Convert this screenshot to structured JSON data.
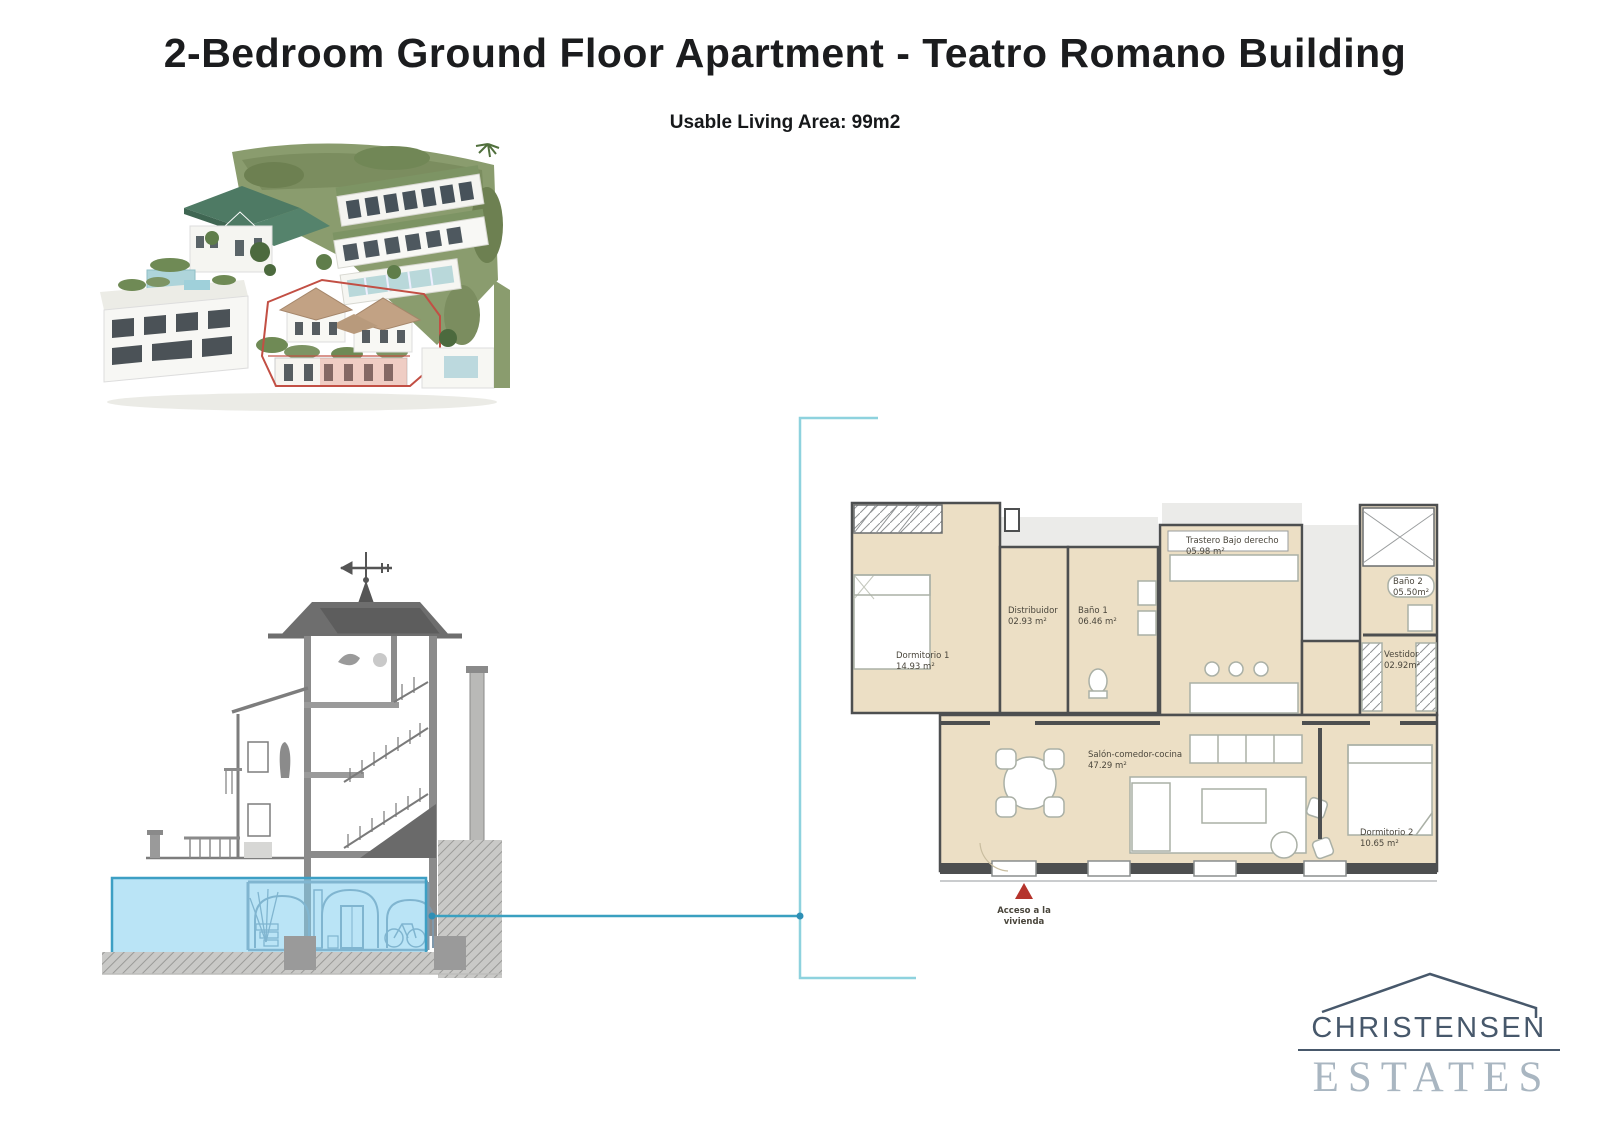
{
  "page": {
    "title": "2-Bedroom Ground Floor Apartment - Teatro Romano Building",
    "subtitle": "Usable Living Area: 99m2"
  },
  "floorplan": {
    "rooms": [
      {
        "name": "Dormitorio 1",
        "area": "14.93 m²"
      },
      {
        "name": "Distribuidor",
        "area": "02.93 m²"
      },
      {
        "name": "Baño 1",
        "area": "06.46 m²"
      },
      {
        "name": "Trastero Bajo derecho",
        "area": "05.98 m²"
      },
      {
        "name": "Baño 2",
        "area": "05.50m²"
      },
      {
        "name": "Vestidor",
        "area": "02.92m²"
      },
      {
        "name": "Salón-comedor-cocina",
        "area": "47.29 m²"
      },
      {
        "name": "Dormitorio 2",
        "area": "10.65 m²"
      }
    ],
    "access": {
      "line1": "Acceso a la",
      "line2": "vivienda"
    }
  },
  "logo": {
    "name": "CHRISTENSEN",
    "tagline": "ESTATES"
  },
  "colors": {
    "room_fill": "#ecdfc5",
    "wall": "#4d4f50",
    "highlight_fill": "rgba(130,205,238,0.55)",
    "highlight_border": "#3d9fc4",
    "connector_light": "#8ed2de",
    "connector_dark": "#2f9ec2",
    "access_red": "#b5342c",
    "logo_dark": "#47586b",
    "logo_light": "#a9b6c1",
    "plot_outline_red": "#c24f44"
  }
}
